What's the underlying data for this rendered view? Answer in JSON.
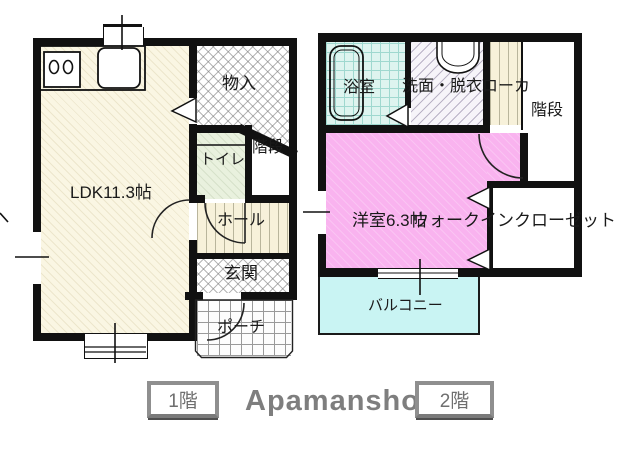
{
  "floor1": {
    "rooms": {
      "ldk": "LDK11.3帖",
      "storage": "物入",
      "toilet": "トイレ",
      "stairs": "階段",
      "hall": "ホール",
      "entrance": "玄関",
      "porch": "ポーチ"
    }
  },
  "floor2": {
    "rooms": {
      "bath": "浴室",
      "washroom": "洗面・脱衣ローカ",
      "stairs": "階段",
      "bedroom": "洋室6.3帖",
      "closet": "ウォークインクローゼット",
      "balcony": "バルコニー"
    }
  },
  "footer": {
    "floor1_button": "1階",
    "brand": "Apamanshop",
    "floor2_button": "2階"
  },
  "colors": {
    "wall": "#111111",
    "ldk_floor": "#faf6e3",
    "toilet_floor": "#e9f1de",
    "hall_floor": "#f7f1da",
    "bath_floor": "#def4ef",
    "bedroom_floor": "#f9b3ef",
    "balcony_floor": "#c9f4f3",
    "brand_text": "#7e7e7e"
  }
}
